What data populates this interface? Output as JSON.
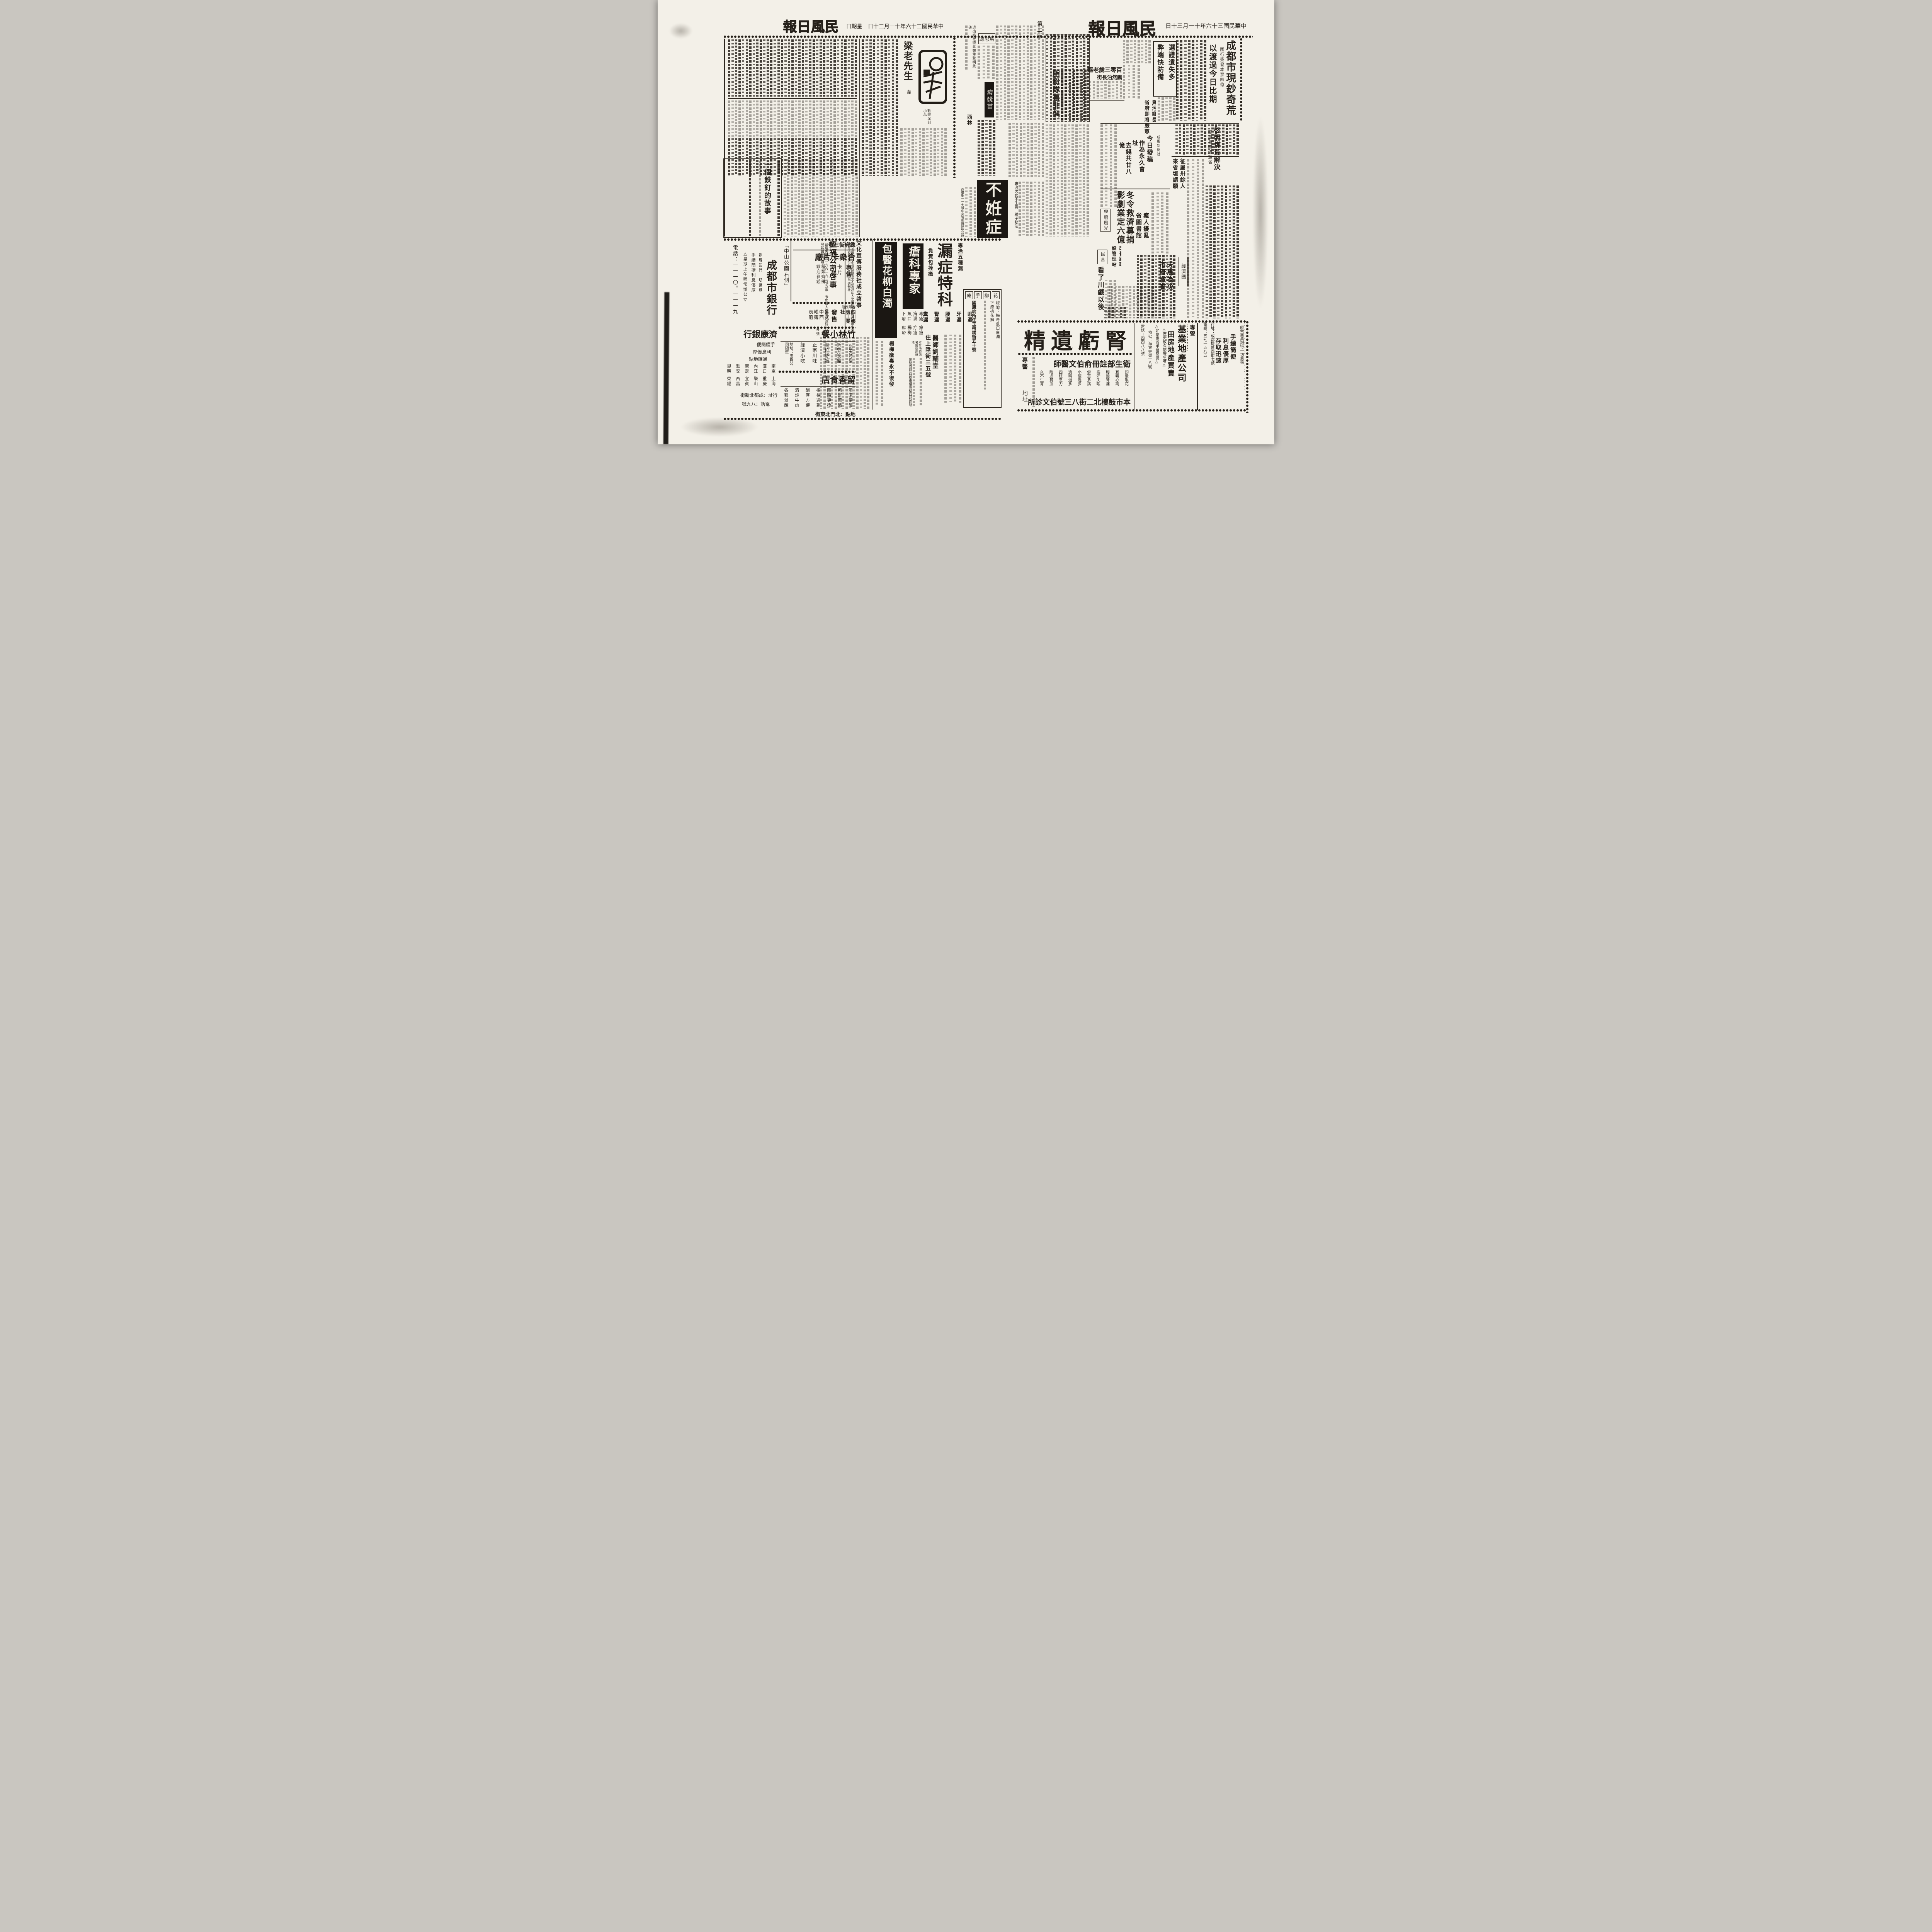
{
  "paper": {
    "name": "民風日報",
    "date": "中華民國三十六年十一月三十日",
    "weekday": "星期日",
    "edition": "第二版"
  },
  "right_news": {
    "lead": {
      "kicker": "國行簽發本票四億",
      "title": "成都市現鈔奇荒",
      "subtitle": "以渡過今日比期"
    },
    "ticket_box": {
      "line1": "選證遺失多",
      "line2": "弊端快防備"
    },
    "old_woman": {
      "line1": "百零三歲老嫗",
      "line2": "飄然泊長街"
    },
    "powder": {
      "title": "脂粉隊裏非偶"
    },
    "corrupt": {
      "line1": "貪污鄉長",
      "line2": "省府即將嚴懲"
    },
    "council": {
      "line1": "省參會買沙利文",
      "line2": "作為永久會址",
      "line3": "去錢共廿八億"
    },
    "press": {
      "kicker": "成風新聞社",
      "title": "今日發稿"
    },
    "coal": {
      "title": "啓明煤荒解決",
      "subtitle": "關鍵為購煤運省"
    },
    "petition": {
      "kicker": "鄉長扣優待米",
      "line1": "征屬卅餘人",
      "line2": "來省垣請願"
    },
    "winter": {
      "line1": "冬令救濟募捐",
      "line2": "影劇業定六億"
    },
    "roads": {
      "line1": "改善路政",
      "line2": "設管理站"
    },
    "madman": {
      "line1": "瘋人擾亂",
      "line2": "省圖書館"
    },
    "campus": {
      "title": "學府風光"
    },
    "minyan": {
      "column": "民言",
      "title": "看了川戲以後"
    },
    "economy": {
      "column": "經濟圈",
      "line1": "天馬為災",
      "line2": "市府澈查"
    }
  },
  "supplement": {
    "statement": "退出該社特此鄭重聲明此啓",
    "music_title": "馬思聰",
    "vaccine": "痘漿苗",
    "xilin": "西林",
    "story1": {
      "title": "梁老先生",
      "author": "韋",
      "caption": "歡迎深刻小品"
    },
    "story2": {
      "title": "一個鉄釘的故事"
    }
  },
  "ads": {
    "infertility": {
      "title": "不姙症",
      "note": "專治男女不生育　種子秘法",
      "address": "西御街一一七號中央電影院隔壁診所"
    },
    "lou": {
      "kicker": "專治五種漏",
      "title": "漏症特科",
      "pledge": "負責包拴癒",
      "symptoms": [
        "眼漏",
        "牙漏",
        "腰漏",
        "腎漏",
        "糞漏"
      ],
      "doctor": "醫師劉輔堂",
      "doctor_addr": "住上陞街三五號"
    },
    "sore": {
      "title": "瘡科專家",
      "symptoms": [
        "毒瘡",
        "痔漏",
        "魚口",
        "下疳",
        "瘰癧",
        "疔瘡",
        "楊梅",
        "癬疥"
      ],
      "note": "本診所特聘名醫採用新法"
    },
    "liuzhuo": {
      "title": "包醫花柳白濁",
      "footer1": "楊梅瘡毒永不復發"
    },
    "sore_footer": "地點春熙西段茶樓隔壁四能診所",
    "guokang": {
      "title_chars": [
        "花",
        "柳",
        "手",
        "療"
      ],
      "body1": "經治：梅毒魚口白濁",
      "body2": "下疳桃花癬",
      "address": "國康診所住玉帶橋街五十號"
    },
    "hengfu": {
      "title": "恆福公司啓事",
      "body": "茲遺失滙票一六六一九三號支票一張出票人德康商號特此登報聲明作廢"
    },
    "culture": {
      "title": "文化宣傳服務社成立啓事",
      "body": "為社會服務在不違反國家法令及攻訐私人之原則下經收各種廣告宣傳社址擬督東街五十九號大中週刊社"
    },
    "city_bank": {
      "location": "「中山公園右側」",
      "name": "成都市銀行",
      "line1": "辦理銀行一切業務",
      "line2": "手續簡捷利息優厚",
      "note": "△星期上午照常辦公▽",
      "phone": "電話：一一一〇。一一一九"
    },
    "card_factory": {
      "address": "總府街三號",
      "name": "合衆卡片廠",
      "sell": "專售",
      "items": [
        "卡片",
        "請帖"
      ],
      "note1": "種類齊備",
      "note2": "歡迎參觀"
    },
    "account_books": {
      "area": "春熙西段",
      "name": "四川帳表工業社",
      "sell": "發售",
      "item1": "各式中西",
      "item2": "帳簿表册"
    },
    "bamboo": {
      "name": "竹林小餐",
      "branch": "分號",
      "features_title": "（四大特色）",
      "features": [
        "新型設備",
        "座位舒適",
        "正宗川味",
        "經濟小吃"
      ],
      "address": "地址：國貨公司隔壁"
    },
    "lixiang": {
      "name": "留香食店",
      "features": [
        "清潔便飯",
        "新鮮菜餚",
        "隨時更換",
        "招待週到",
        "酬客方便",
        "清炖牛肉",
        "各種滷醃"
      ],
      "address": "地點：北門北東街"
    },
    "jikang": {
      "name": "濟康銀行",
      "line1": "手續簡便",
      "line2": "利息優厚",
      "line3": "通匯地點",
      "cities": [
        "南京",
        "上海",
        "漢口",
        "重慶",
        "內江",
        "樂山",
        "康定",
        "宜賓",
        "雅安",
        "西昌",
        "昆明",
        "榮經"
      ],
      "address": "行址：成都北新街",
      "phone": "電話：八九號"
    },
    "kidney": {
      "title": "腎虧遺精",
      "doctor": "衛生部註冊俞伯文醫師",
      "symptoms": [
        "頭暈眼花",
        "耳鳴心跳",
        "腰酸背痛",
        "盜汗失眠",
        "健忘多病",
        "小便過多",
        "遺精過多",
        "四肢乏力",
        "陰虛貧血",
        "久不生育"
      ],
      "left1": "專醫",
      "left2": "地址",
      "address": "本市鼓樓北二街八三號伯文診所"
    },
    "jiye": {
      "kicker": "專營",
      "name": "基業地產公司",
      "main": "田房地產買賣",
      "note1": "△歷史攸久信譽卓著△",
      "note2": "△如蒙賜辦手續簡便△",
      "address": "地址：海會寺街十八號",
      "phone": "電話：四四八八號"
    },
    "yukang": {
      "name": "豫康銀行成都總行",
      "slogan": "經營商業銀行一切業務",
      "features": [
        "手續簡便",
        "利息優厚",
        "存取迅速"
      ],
      "address": "行址：成都提督西街七號",
      "phone": "電話：五七一五八五"
    }
  }
}
